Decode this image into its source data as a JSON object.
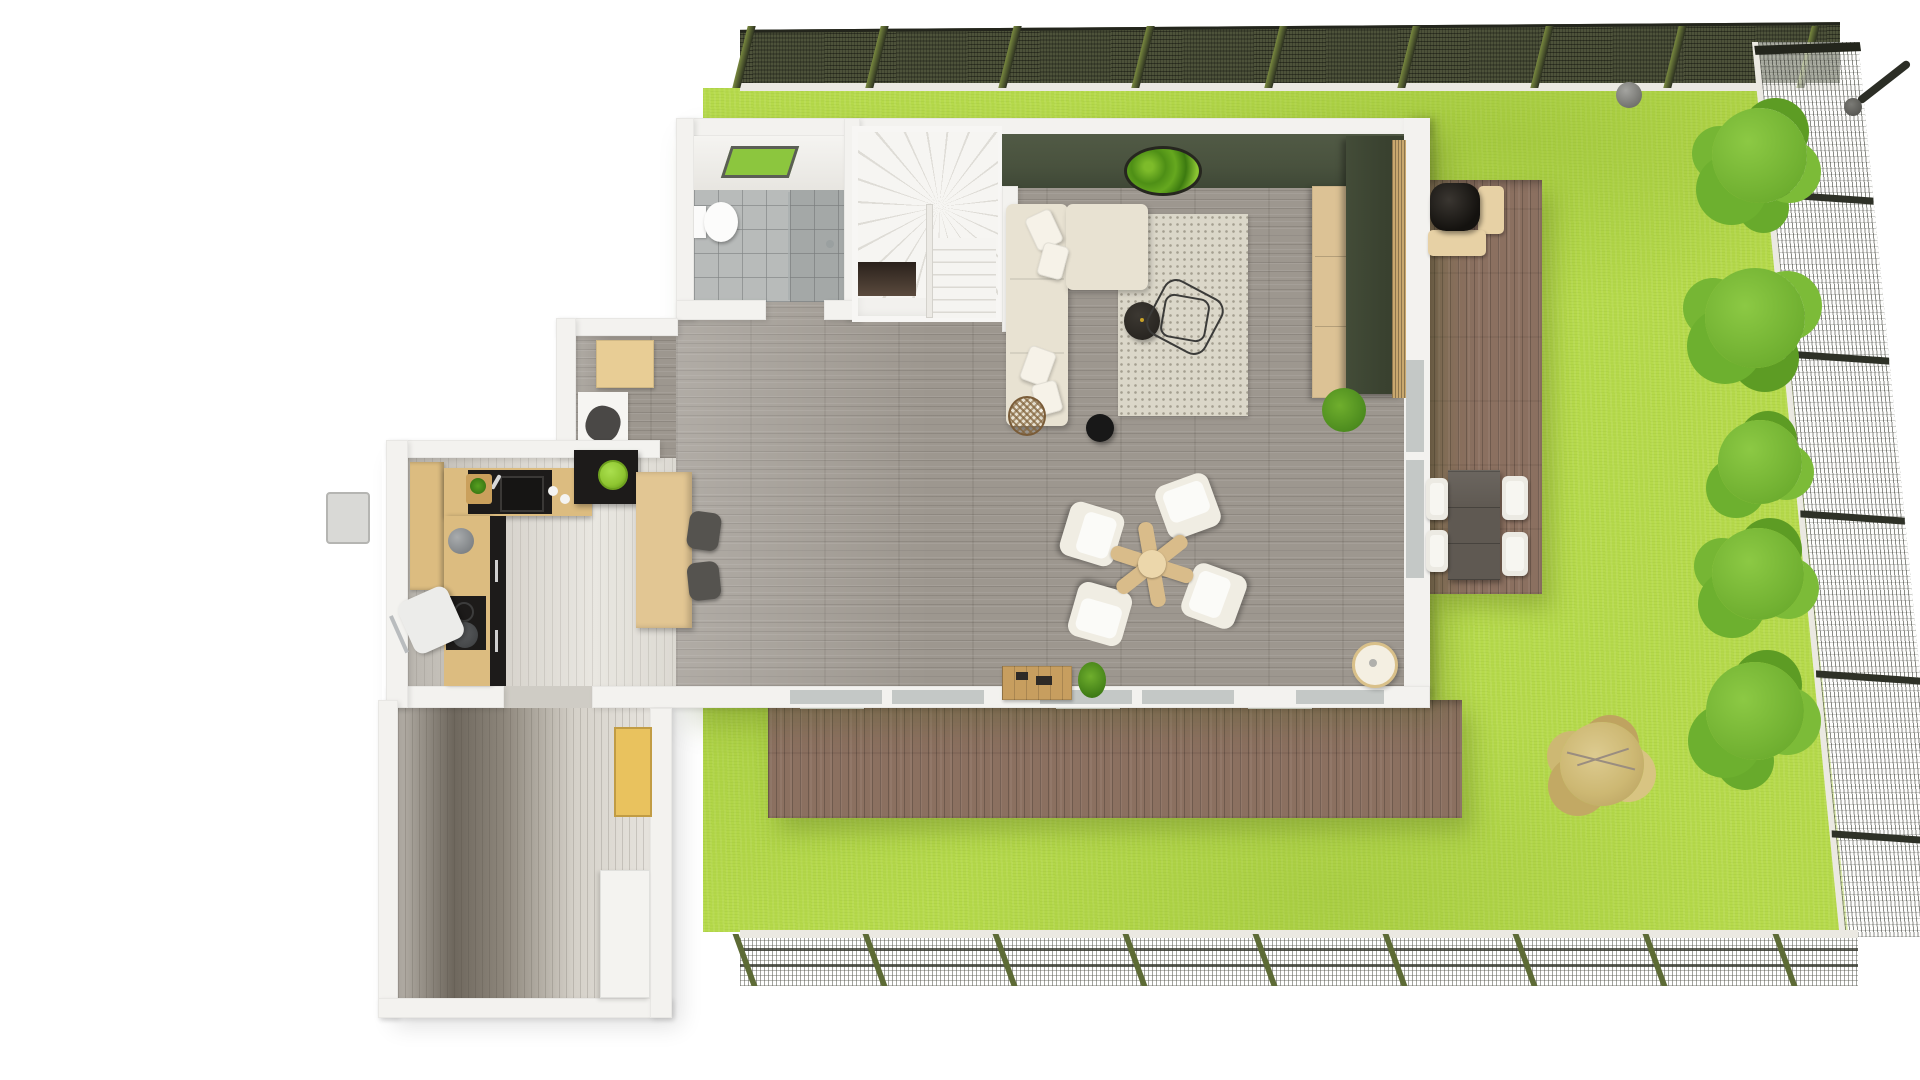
{
  "meta": {
    "title": "3D top-view floor plan render — house with garden, terraces and mesh fencing",
    "view": "top-down 3D architectural visualization",
    "visible_text": "none"
  },
  "rooms": {
    "living": {
      "label": "Living room with gray plank floor"
    },
    "kitchen": {
      "label": "Open kitchen with L-shaped counter and island"
    },
    "bathroom": {
      "label": "Bathroom with shower, toilet and skylight"
    },
    "stairs": {
      "label": "Winder staircase with stairwell void"
    },
    "hallway": {
      "label": "Hallway / entry wing with shelving"
    },
    "alcove": {
      "label": "Alcove nook with bench and desk"
    },
    "garden": {
      "label": "Lawn garden enclosed by mesh fence"
    },
    "deck_side": {
      "label": "Side terrace with outdoor dining set and grill"
    },
    "deck_front": {
      "label": "Front terrace deck with thresholds"
    }
  },
  "items": {
    "sofa": "L-shaped cream sectional sofa with pillows",
    "rug": "Patterned beige area rug",
    "side_table": "Round black side table",
    "wire_table": "Geometric wire coffee table",
    "moss_art": "Round moss wall art on olive accent wall",
    "media_cabinet": "Tall dark-green media cabinet",
    "sideboard": "Light wood sideboard",
    "slat_wall": "Wood slat wall strip",
    "plant": "Potted plant with red blooms",
    "pendant_lamp": "Black round pendant lamp",
    "wicker_sphere": "Rattan sphere decor",
    "lounge_set": "Four white lounge chairs around propeller-shaped wood table",
    "crate_table": "Low wooden crate table with accessories",
    "floor_lamp": "Round cream floor lamp",
    "island": "Black kitchen island with green bowl",
    "counter": "L-shaped wood kitchen counter with black sink and cooktop",
    "pantry": "Tall wood pantry cabinet",
    "bar_table": "Wood bar table with two dark stools",
    "desk_chair": "White desk chair",
    "kettle": "Gray kettle on counter",
    "toilet": "Toilet",
    "skylight": "Green skylight panel",
    "shower": "Walk-in shower with glass divider",
    "dining_set": "Gray outdoor table with four white chairs",
    "grill": "Black kamado grill on beige outdoor bench",
    "bushes": "Five green shrubs along right fence",
    "dry_tree": "Dry tan shrub on lawn",
    "garden_sphere": "Gray garden sphere",
    "leaning_pole": "Leaning fence pole with cap",
    "heat_pump": "Outdoor utility unit",
    "yellow_shelf": "Yellow hallway shelf unit",
    "white_cabinet": "White hallway cabinet"
  },
  "palette": {
    "page_bg": "#ffffff",
    "lawn_base": "#b6da4b",
    "fence_dark": "#4d523a",
    "fence_post": "#5d6b35",
    "curb": "#ebe9e2",
    "deck": "#8b7060",
    "wall": "#f3f2ef",
    "green_wall": "#49523e",
    "floor_gray": "#9d978f",
    "tile": "#b8bbba",
    "wood_counter": "#dcbc80",
    "black": "#1d1b1a",
    "bowl_green": "#8fc631",
    "sofa": "#e8e2d2",
    "pillow": "#f6f2e8",
    "rug": "#dbd7c9",
    "chair_white": "#f0ede3",
    "table_wood": "#d9bc8a",
    "cabinet_green": "#39412f",
    "sideboard_wood": "#dcc295",
    "slat_wood": "#c9a86e",
    "bush_green": "#63a428",
    "bush_light": "#8cc944",
    "dry_tree": "#cdb873",
    "glass": "#c4c8c6",
    "dining_table": "#5f5952",
    "bench": "#e7d1a5",
    "plant_green": "#3e7d18",
    "plant_red": "#c04b2f",
    "gold": "#c9a227"
  }
}
